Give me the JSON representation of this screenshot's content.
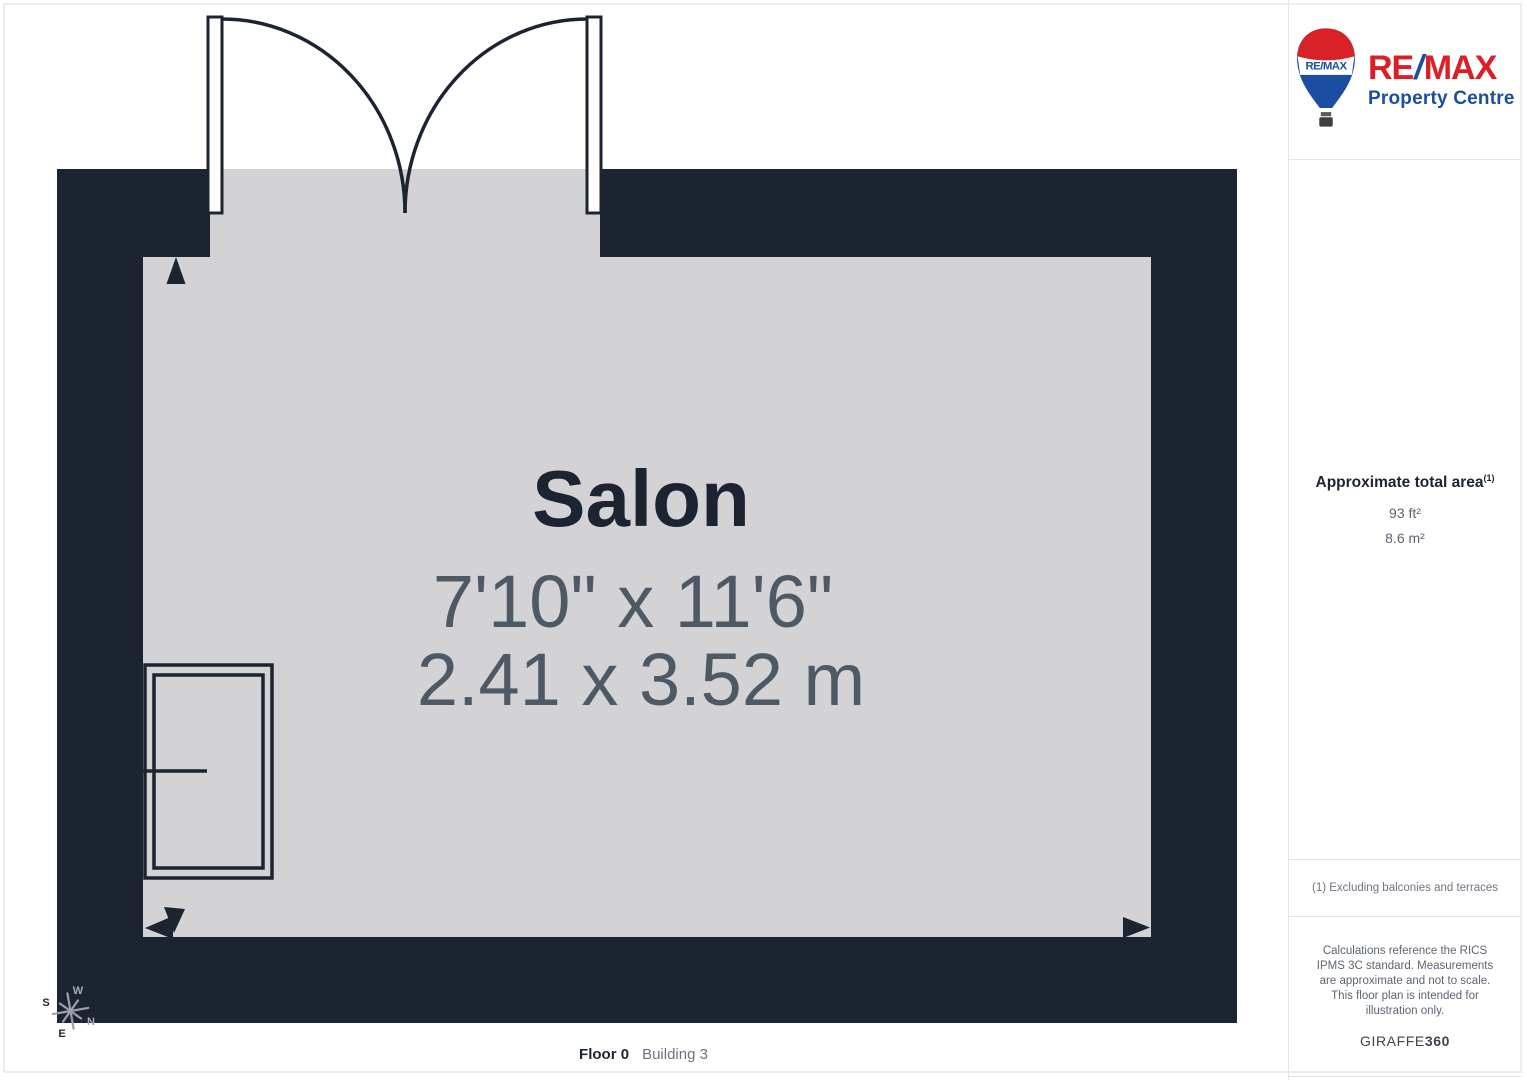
{
  "page": {
    "floor_label": "Floor 0",
    "building_label": "Building 3"
  },
  "room": {
    "name": "Salon",
    "dimensions_imperial": "7'10\" x 11'6\"",
    "dimensions_metric": "2.41 x 3.52 m"
  },
  "compass": {
    "north": "N",
    "south": "S",
    "east": "E",
    "west": "W"
  },
  "sidebar": {
    "logo": {
      "balloon_text": "RE/MAX",
      "brand_re": "RE",
      "brand_slash": "/",
      "brand_max": "MAX",
      "brand_sub": "Property Centre"
    },
    "area": {
      "heading": "Approximate total area",
      "heading_superscript": "(1)",
      "imperial": "93 ft²",
      "metric": "8.6 m²"
    },
    "footnote": "(1) Excluding balconies and terraces",
    "disclaimer": "Calculations reference the RICS IPMS 3C standard. Measurements are approximate and not to scale. This floor plan is intended for illustration only.",
    "credit_name": "GIRAFFE",
    "credit_number": "360"
  },
  "colors": {
    "wall": "#1d2431",
    "floor": "#d3d3d5",
    "room_name_text": "#1d2431",
    "dimension_text": "#4e5966",
    "muted_text": "#6b7280",
    "remax_red": "#dc1f26",
    "remax_blue": "#1b4ea0",
    "divider": "#e5e5e7"
  }
}
